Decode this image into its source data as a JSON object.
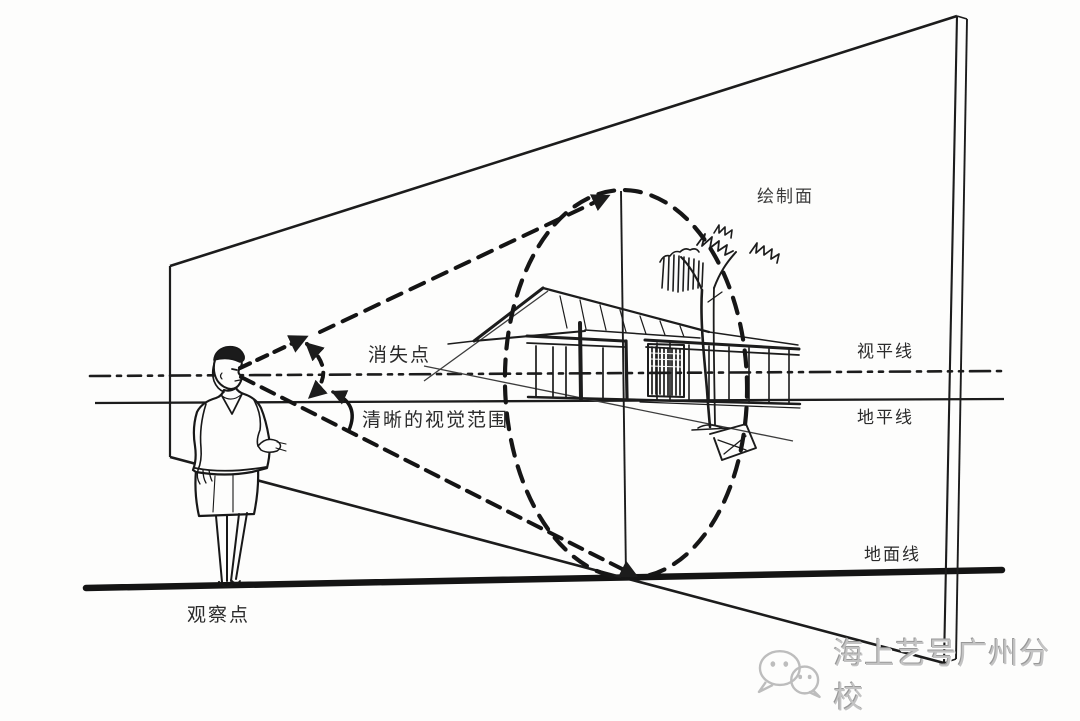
{
  "labels": {
    "drawing_plane": "绘制面",
    "vanishing_point": "消失点",
    "clear_visual_range": "清晰的视觉范围",
    "eye_level_line": "视平线",
    "ground_horizon_line": "地平线",
    "ground_line": "地面线",
    "observation_point": "观察点"
  },
  "watermark": {
    "icon": "wechat-icon",
    "text": "海上艺号广州分校"
  },
  "colors": {
    "ink": "#1c1c1c",
    "label_text": "#2b2b2b",
    "watermark_gray": "#c3c3c3",
    "background": "#fdfdfc"
  }
}
